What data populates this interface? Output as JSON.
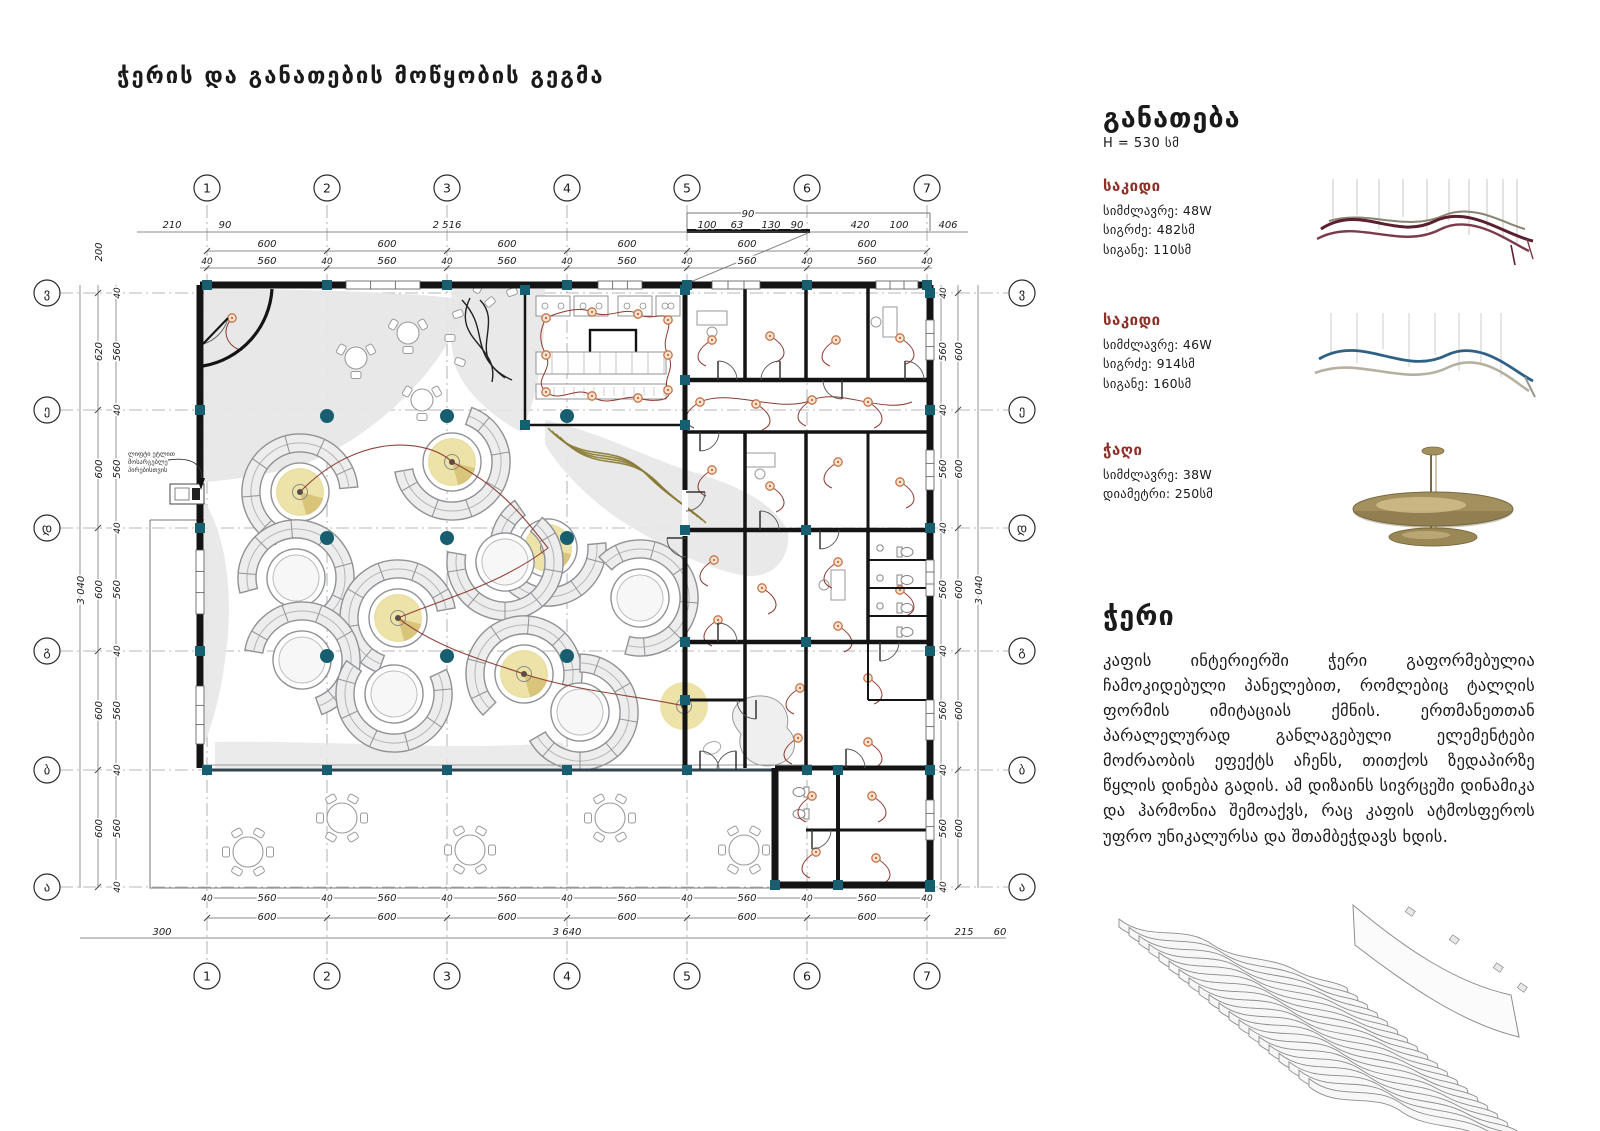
{
  "title": "ჭერის და განათების მოწყობის გეგმა",
  "colors": {
    "accent_red": "#8e2f27",
    "wire": "#8c3a30",
    "structure_teal": "#175e70",
    "glow": "#ecdfa0",
    "light": "#c4764a",
    "wall": "#141414"
  },
  "legend": {
    "heading": "განათება",
    "height_note": "H = 530 სმ",
    "items": [
      {
        "name": "საკიდი",
        "specs": [
          "სიმძლავრე: 48W",
          "სიგრძე: 482სმ",
          "სიგანე: 110სმ"
        ]
      },
      {
        "name": "საკიდი",
        "specs": [
          "სიმძლავრე: 46W",
          "სიგრძე: 914სმ",
          "სიგანე: 160სმ"
        ]
      },
      {
        "name": "ჭაღი",
        "specs": [
          "სიმძლავრე: 38W",
          "დიამეტრი: 250სმ"
        ]
      }
    ]
  },
  "ceiling": {
    "heading": "ჭერი",
    "body": "კაფის ინტერიერში ჭერი გაფორმებულია ჩამოკიდებული პანელებით, რომლებიც ტალღის ფორმის იმიტაციას ქმნის. ერთმანეთთან პარალელურად განლაგებული ელემენტები მოძრაობის ეფექტს აჩენს, თითქოს ზედაპირზე წყლის დინება გადის. ამ დიზაინს სივრცეში დინამიკა და ჰარმონია შემოაქვს, რაც კაფის ატმოსფეროს უფრო უნიკალურსა და შთამბეჭდავს ხდის."
  },
  "plan": {
    "annotation": [
      "ლიფტი ეტლით",
      "მოსარგებლე",
      "პირებისთვის"
    ],
    "grid": {
      "cols": [
        "1",
        "2",
        "3",
        "4",
        "5",
        "6",
        "7"
      ],
      "rows": [
        "ვ",
        "ე",
        "დ",
        "გ",
        "ბ",
        "ა"
      ]
    },
    "dims": {
      "top_outer": [
        "210",
        "90",
        "2 516",
        "100",
        "63",
        "130",
        "90",
        "420",
        "100",
        "406"
      ],
      "top_canopy": "90",
      "bay": "600",
      "inner_bay": "560",
      "inner_gap": "40",
      "bottom_outer": [
        "300",
        "3 640",
        "215",
        "60"
      ],
      "left_outer": [
        "620",
        "600",
        "600",
        "600",
        "600"
      ],
      "right_outer": [
        "600",
        "600",
        "600",
        "600",
        "600"
      ],
      "left_top": "200",
      "side_total": "3 040"
    }
  }
}
